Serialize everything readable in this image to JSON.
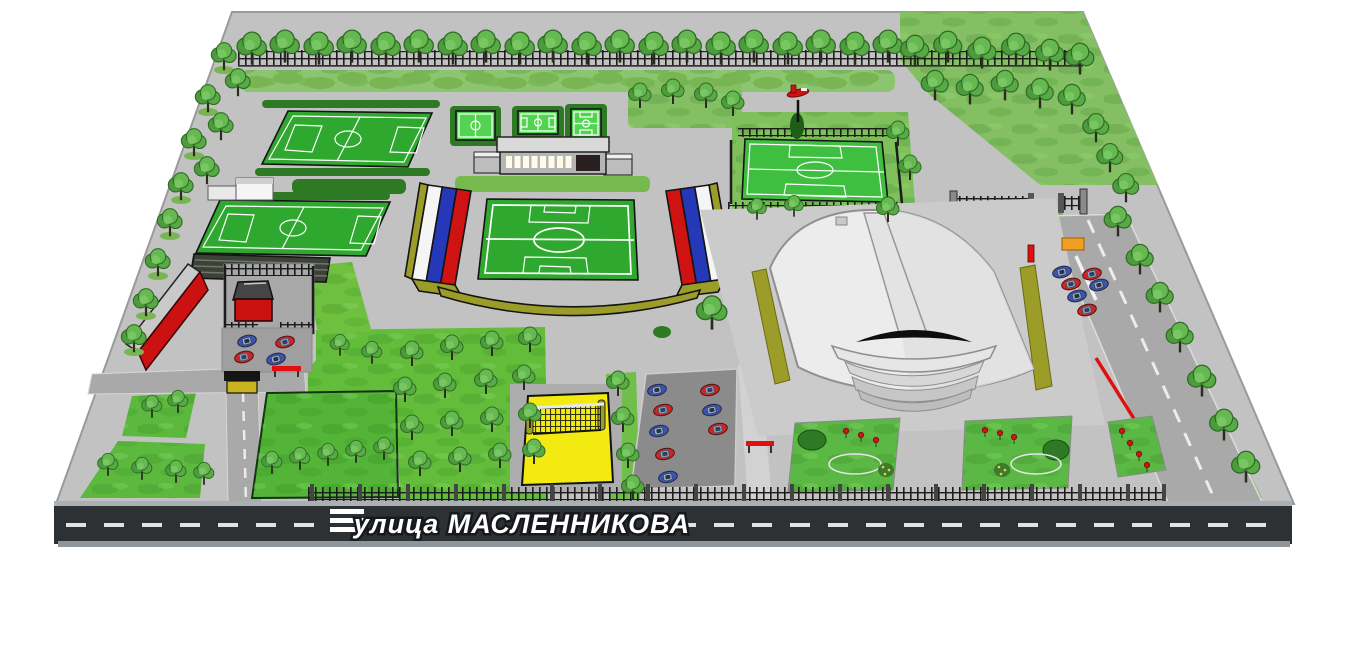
{
  "street": {
    "label": "улица МАСЛЕННИКОВА"
  },
  "colors": {
    "page_bg": "#ffffff",
    "asphalt": "#c2c2c2",
    "road": "#a9a9a9",
    "street_asphalt": "#2e3134",
    "lane_marking": "#dfe3e6",
    "label_white": "#ffffff",
    "grass": "#63bd3a",
    "grass_light": "#85bf63",
    "hedge": "#2e7a24",
    "pitch_green": "#2ea82e",
    "court_green": "#52d452",
    "flag_white": "#f5f5f5",
    "flag_blue": "#2438b8",
    "flag_red": "#cf1212",
    "olive": "#9c9c28",
    "arena_body": "#ececec",
    "red_building": "#cc1111",
    "car_red": "#c62828",
    "car_blue": "#4053a8",
    "volleyball_yellow": "#f2ea10",
    "flower_red": "#cc1616",
    "fence_black": "#1c1c1c",
    "barrier_red": "#e01010",
    "bench_orange": "#f0a020"
  },
  "counts": {
    "cars_central_parking": 8,
    "cars_west_parking": 4,
    "cars_east_road": 6
  },
  "map_elements": [
    "main-stadium-with-tricolor-stands",
    "indoor-arena",
    "training-field-upper",
    "training-field-lower",
    "football-field-north-east",
    "mini-courts",
    "sports-pavilion",
    "volleyball-court",
    "tree-grove",
    "central-parking",
    "west-parking",
    "east-road-parking",
    "flower-beds",
    "guard-house",
    "ticket-booth",
    "red-service-building",
    "airplane-monument",
    "street-maslennikova"
  ]
}
